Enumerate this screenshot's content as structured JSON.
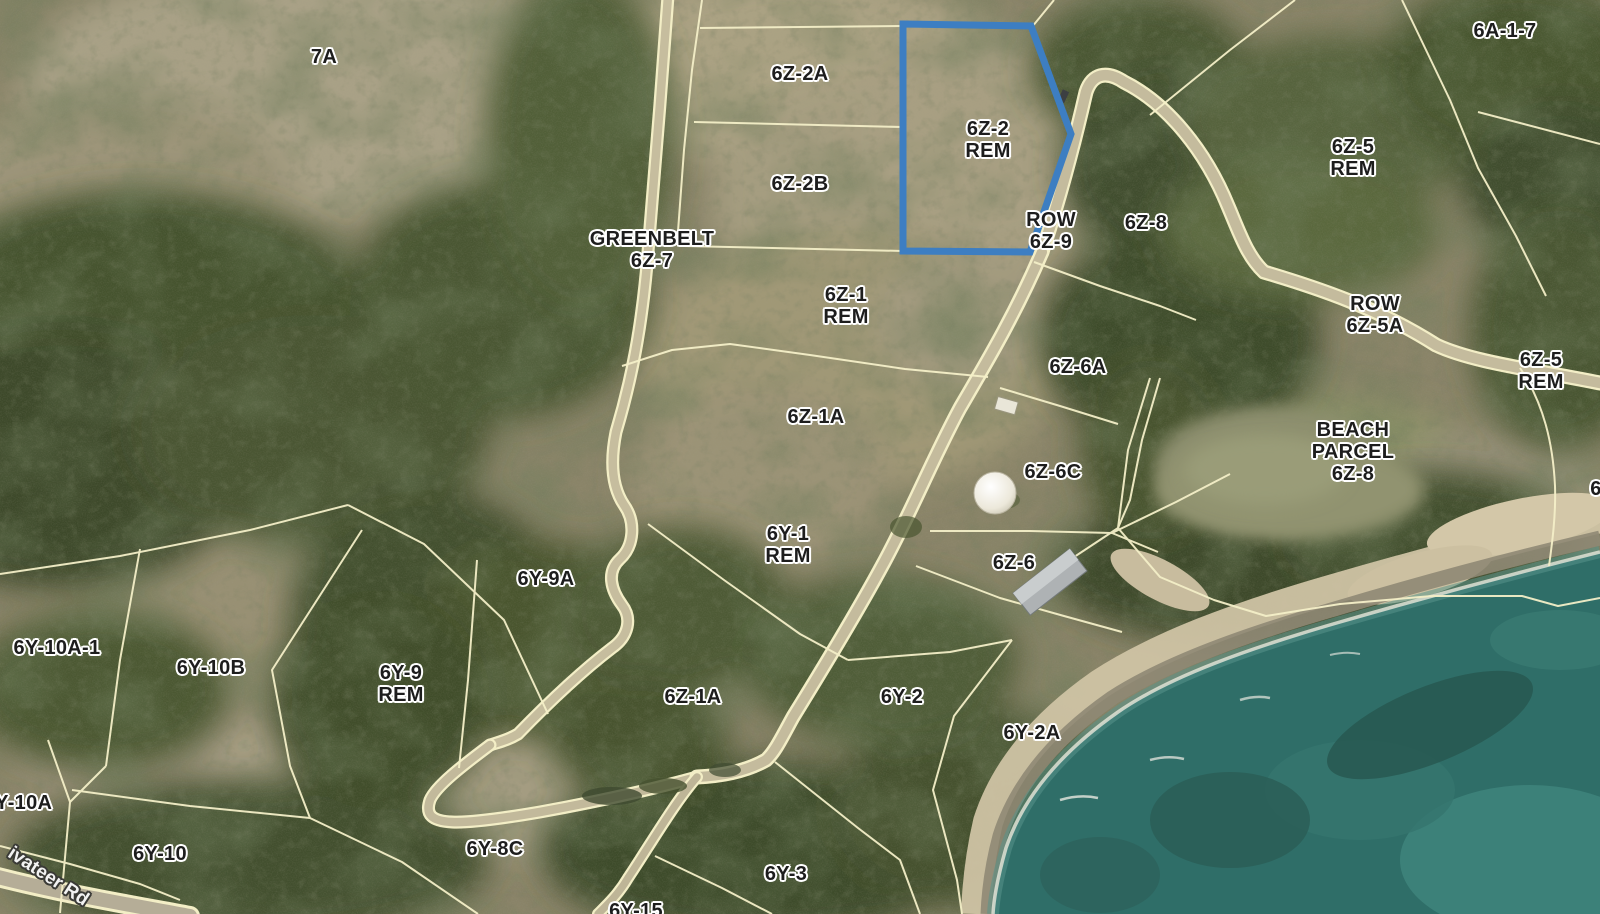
{
  "map": {
    "parcel_labels": [
      {
        "name": "7a",
        "lines": [
          "7A"
        ],
        "x": 324,
        "y": 57
      },
      {
        "name": "6z-2a",
        "lines": [
          "6Z-2A"
        ],
        "x": 800,
        "y": 74
      },
      {
        "name": "6z-2-rem",
        "lines": [
          "6Z-2",
          "REM"
        ],
        "x": 988,
        "y": 140
      },
      {
        "name": "6a-1-7",
        "lines": [
          "6A-1-7"
        ],
        "x": 1505,
        "y": 31
      },
      {
        "name": "6z-5-rem-upper",
        "lines": [
          "6Z-5",
          "REM"
        ],
        "x": 1353,
        "y": 158
      },
      {
        "name": "6z-2b",
        "lines": [
          "6Z-2B"
        ],
        "x": 800,
        "y": 184
      },
      {
        "name": "greenbelt-6z-7",
        "lines": [
          "GREENBELT",
          "6Z-7"
        ],
        "x": 652,
        "y": 250
      },
      {
        "name": "row-6z-9",
        "lines": [
          "ROW",
          "6Z-9"
        ],
        "x": 1051,
        "y": 231
      },
      {
        "name": "6z-8",
        "lines": [
          "6Z-8"
        ],
        "x": 1146,
        "y": 223
      },
      {
        "name": "row-6z-5a",
        "lines": [
          "ROW",
          "6Z-5A"
        ],
        "x": 1375,
        "y": 315
      },
      {
        "name": "6z-5-rem-right",
        "lines": [
          "6Z-5",
          "REM"
        ],
        "x": 1541,
        "y": 371
      },
      {
        "name": "6z-1-rem",
        "lines": [
          "6Z-1",
          "REM"
        ],
        "x": 846,
        "y": 306
      },
      {
        "name": "6z-6a",
        "lines": [
          "6Z-6A"
        ],
        "x": 1078,
        "y": 367
      },
      {
        "name": "beach-parcel-6z-8",
        "lines": [
          "BEACH",
          "PARCEL",
          "6Z-8"
        ],
        "x": 1353,
        "y": 452
      },
      {
        "name": "6z-1a-upper",
        "lines": [
          "6Z-1A"
        ],
        "x": 816,
        "y": 417
      },
      {
        "name": "6z-6c",
        "lines": [
          "6Z-6C"
        ],
        "x": 1053,
        "y": 472
      },
      {
        "name": "6y-1-rem",
        "lines": [
          "6Y-1",
          "REM"
        ],
        "x": 788,
        "y": 545
      },
      {
        "name": "6z-6",
        "lines": [
          "6Z-6"
        ],
        "x": 1014,
        "y": 563
      },
      {
        "name": "6y-9a",
        "lines": [
          "6Y-9A"
        ],
        "x": 546,
        "y": 579
      },
      {
        "name": "6y-10a-1",
        "lines": [
          "6Y-10A-1"
        ],
        "x": 57,
        "y": 648
      },
      {
        "name": "6y-10b",
        "lines": [
          "6Y-10B"
        ],
        "x": 211,
        "y": 668
      },
      {
        "name": "6y-9-rem",
        "lines": [
          "6Y-9",
          "REM"
        ],
        "x": 401,
        "y": 684
      },
      {
        "name": "6z-1a-lower",
        "lines": [
          "6Z-1A"
        ],
        "x": 693,
        "y": 697
      },
      {
        "name": "6y-2",
        "lines": [
          "6Y-2"
        ],
        "x": 902,
        "y": 697
      },
      {
        "name": "6y-2a",
        "lines": [
          "6Y-2A"
        ],
        "x": 1032,
        "y": 733
      },
      {
        "name": "6y-10a",
        "lines": [
          "6Y-10A"
        ],
        "x": 18,
        "y": 803
      },
      {
        "name": "6y-10",
        "lines": [
          "6Y-10"
        ],
        "x": 160,
        "y": 854
      },
      {
        "name": "6y-8c",
        "lines": [
          "6Y-8C"
        ],
        "x": 495,
        "y": 849
      },
      {
        "name": "6y-3",
        "lines": [
          "6Y-3"
        ],
        "x": 786,
        "y": 874
      },
      {
        "name": "6y-15",
        "lines": [
          "6Y-15"
        ],
        "x": 636,
        "y": 911
      },
      {
        "name": "edge-6",
        "lines": [
          "6"
        ],
        "x": 1596,
        "y": 489
      }
    ],
    "road_labels": [
      {
        "name": "privateer-rd",
        "text": "ivateer Rd",
        "x": 48,
        "y": 877,
        "rotation": 33
      }
    ],
    "highlight_parcel": {
      "label": "6Z-2 REM",
      "points": "903,24 1031,26 1071,134 1030,252 903,251",
      "color": "#3d7ec2"
    },
    "colors": {
      "highlight": "#3d7ec2",
      "boundary_line": "#f4efc8",
      "road_surface": "#c4bb9d",
      "water": "#2f6e68",
      "sand": "#cfc3a4",
      "label_text": "#1d1d1d",
      "label_halo": "#ffffff",
      "road_label_text": "#f2f2f2"
    }
  }
}
